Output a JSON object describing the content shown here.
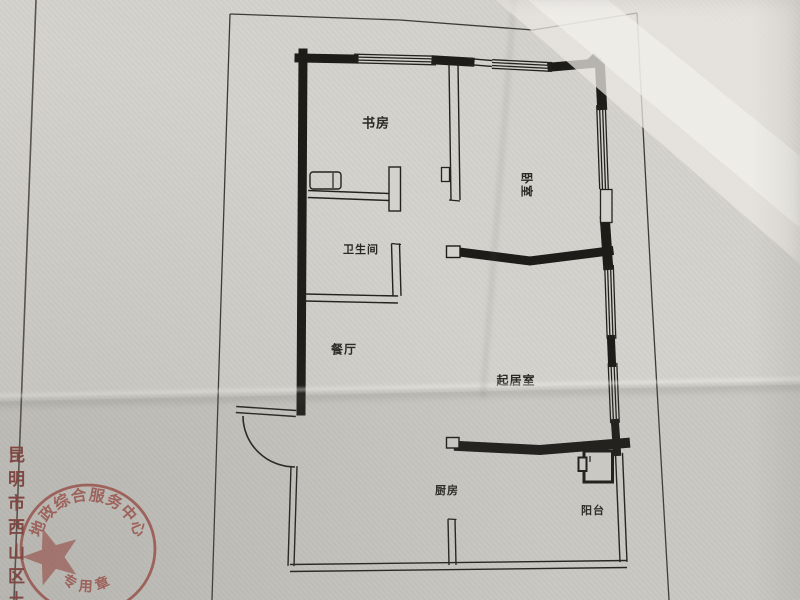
{
  "rooms": {
    "study": "书房",
    "bedroom": "卧室",
    "bathroom": "卫生间",
    "dining": "餐厅",
    "living": "起居室",
    "kitchen": "厨房",
    "balcony": "阳台"
  },
  "side_text": {
    "text": "昆明市西山区土"
  },
  "stamp": {
    "arc_text": "地政综合服务中心",
    "bottom_text": "专用章"
  },
  "colors": {
    "paper": "#d4d2cd",
    "ink": "#1d1c18",
    "stamp_red": "#a8524a",
    "side_text_red": "#8a443e"
  }
}
